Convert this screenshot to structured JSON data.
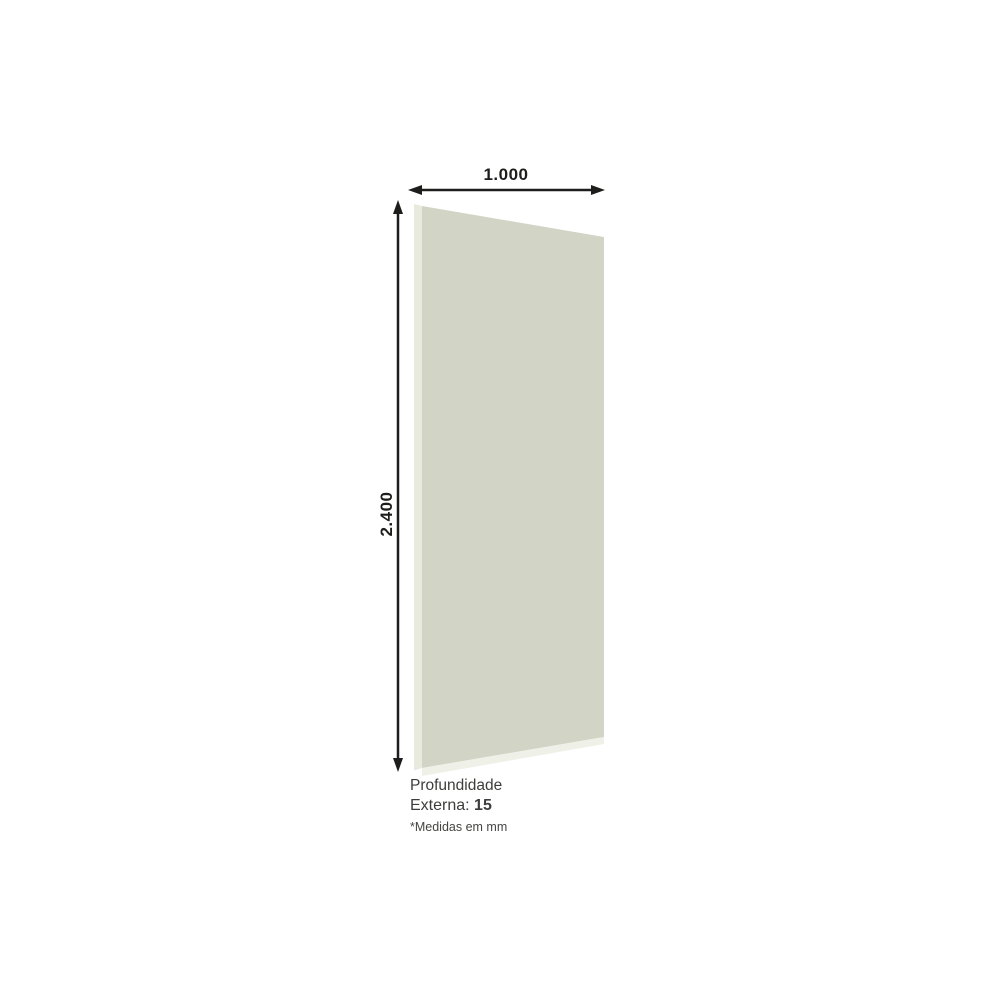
{
  "diagram": {
    "width_label": "1.000",
    "height_label": "2.400",
    "panel_color": "#d2d4c5",
    "panel_edge_left_color": "#e8eadd",
    "panel_edge_bottom_color": "#eff0e7",
    "dimension_color": "#1d1d1b"
  },
  "caption": {
    "title": "Profundidade",
    "depth_label": "Externa:",
    "depth_value": "15",
    "note": "*Medidas em mm",
    "text_color": "#3d3d3b"
  },
  "page": {
    "background_color": "#ffffff"
  }
}
